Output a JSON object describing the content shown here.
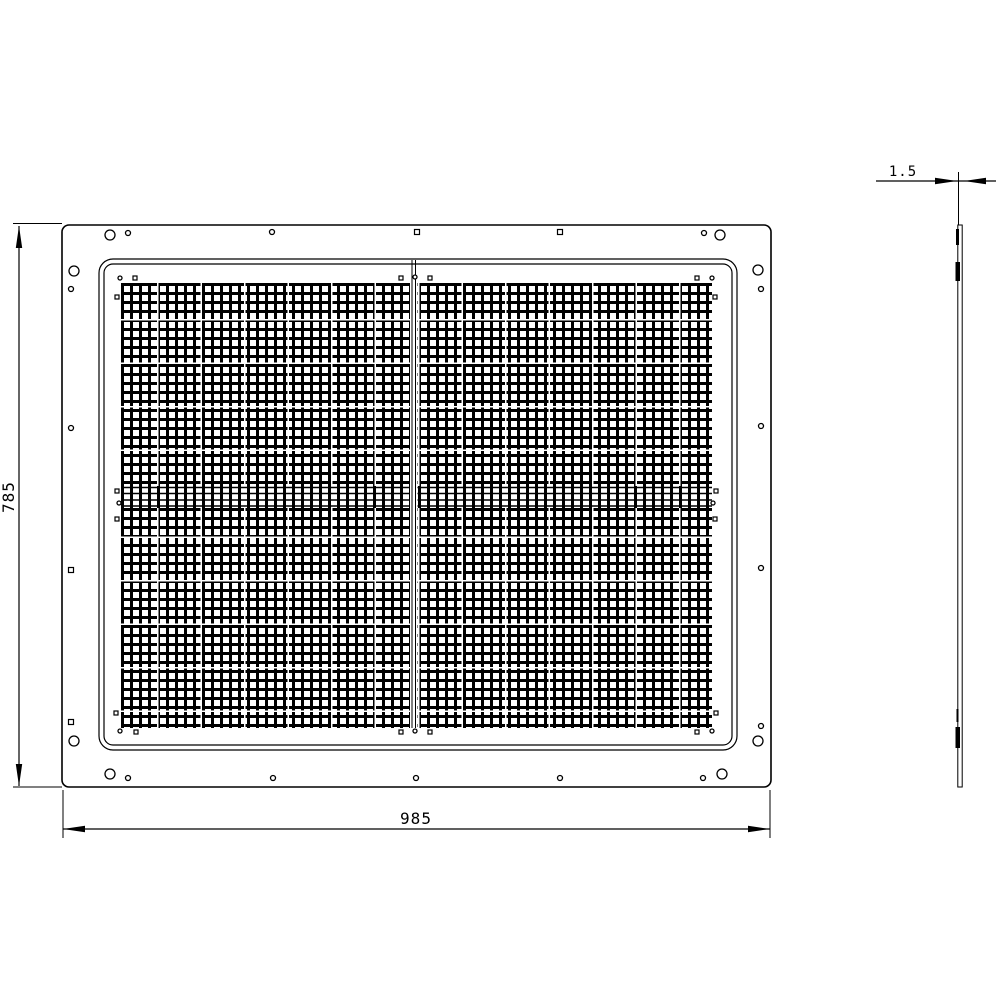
{
  "page": {
    "background": "#ffffff",
    "line_color": "#000000",
    "description": "CAD technical drawing of a perforated EMC shielding panel, front view and side (thickness) view"
  },
  "drawing": {
    "dimensions": {
      "height": {
        "label": "785"
      },
      "width": {
        "label": "985"
      },
      "thickness": {
        "label": "1.5"
      }
    },
    "front_view": {
      "outer_panel": {
        "x": 62,
        "y": 225,
        "w": 709,
        "h": 562,
        "r": 7
      },
      "frame_outer": {
        "x": 99,
        "y": 259,
        "w": 638,
        "h": 491,
        "r": 14
      },
      "frame_inner": {
        "x": 104,
        "y": 264,
        "w": 628,
        "h": 481,
        "r": 9
      },
      "mesh": {
        "x": 121,
        "y": 283,
        "w": 591,
        "h": 445
      },
      "holes": {
        "circles": [
          [
            110,
            235,
            5
          ],
          [
            128,
            233,
            2.5
          ],
          [
            272,
            232,
            2.5
          ],
          [
            704,
            233,
            2.5
          ],
          [
            720,
            235,
            5
          ],
          [
            74,
            271,
            5
          ],
          [
            71,
            289,
            2.5
          ],
          [
            71,
            428,
            2.5
          ],
          [
            758,
            270,
            5
          ],
          [
            761,
            289,
            2.5
          ],
          [
            761,
            426,
            2.5
          ],
          [
            761,
            568,
            2.5
          ],
          [
            761,
            726,
            2.5
          ],
          [
            758,
            741,
            5
          ],
          [
            74,
            741,
            5
          ],
          [
            110,
            774,
            5
          ],
          [
            128,
            778,
            2.5
          ],
          [
            273,
            778,
            2.5
          ],
          [
            416,
            778,
            2.5
          ],
          [
            560,
            778,
            2.5
          ],
          [
            703,
            778,
            2.5
          ],
          [
            722,
            774,
            5
          ],
          [
            120,
            278,
            2
          ],
          [
            712,
            278,
            2
          ],
          [
            415,
            277,
            2
          ],
          [
            119,
            503,
            2
          ],
          [
            713,
            503,
            2
          ],
          [
            120,
            731,
            2
          ],
          [
            712,
            731,
            2
          ],
          [
            415,
            731,
            2
          ]
        ],
        "squares": [
          [
            417,
            232,
            5
          ],
          [
            560,
            232,
            5
          ],
          [
            71,
            570,
            5
          ],
          [
            71,
            722,
            5
          ],
          [
            135,
            278,
            4
          ],
          [
            117,
            297,
            4
          ],
          [
            697,
            278,
            4
          ],
          [
            715,
            297,
            4
          ],
          [
            401,
            278,
            4
          ],
          [
            430,
            278,
            4
          ],
          [
            117,
            491,
            4
          ],
          [
            117,
            519,
            4
          ],
          [
            716,
            491,
            4
          ],
          [
            715,
            519,
            4
          ],
          [
            116,
            713,
            4
          ],
          [
            136,
            732,
            4
          ],
          [
            716,
            713,
            4
          ],
          [
            697,
            732,
            4
          ],
          [
            401,
            732,
            4
          ],
          [
            430,
            732,
            4
          ]
        ]
      }
    },
    "side_view": {
      "plate": {
        "x": 957.8,
        "y": 225,
        "w": 4.4,
        "h": 562
      },
      "tabs": [
        [
          956,
          229,
          3,
          16
        ],
        [
          955.5,
          262,
          4.5,
          19
        ],
        [
          956.5,
          709,
          2,
          13
        ],
        [
          955.5,
          727,
          4.5,
          21
        ]
      ]
    }
  }
}
